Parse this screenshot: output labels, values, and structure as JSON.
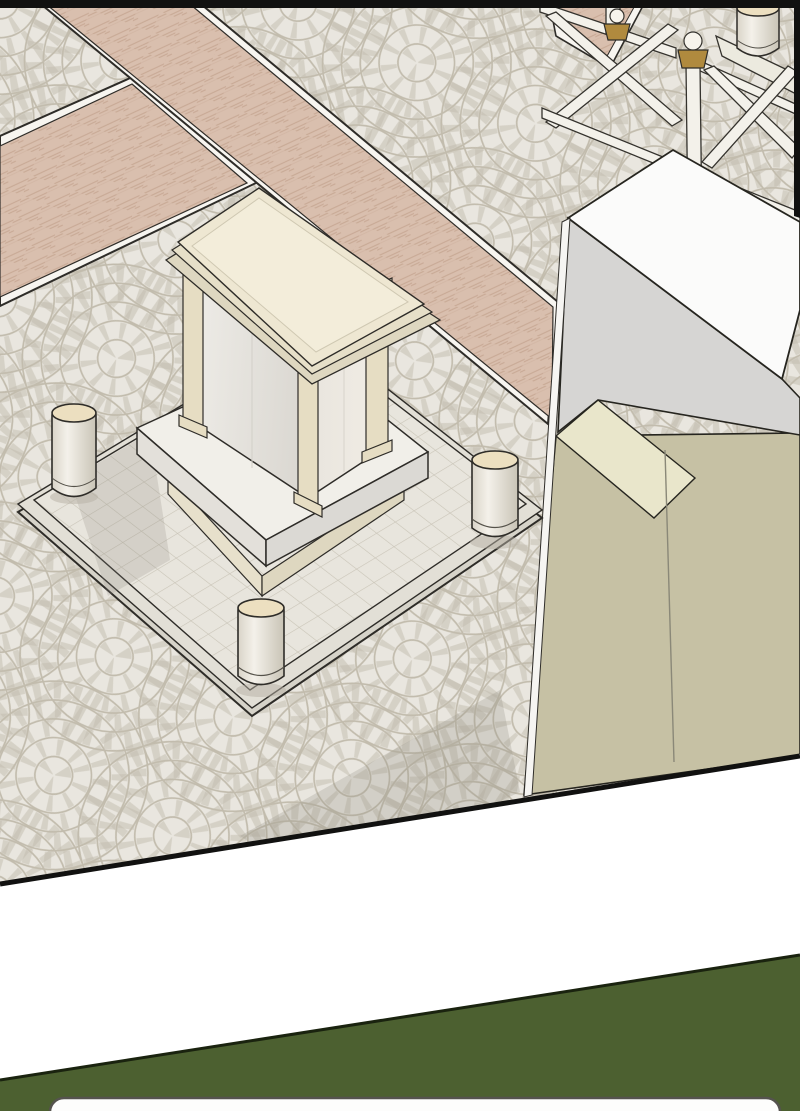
{
  "scene": {
    "kind": "webtoon-comic-panel",
    "description": "SketchUp-style 3D render of a plaza: a white marble monument pedestal with corner pilasters on a tiled platform with four corner bollards, fan-pattern cobblestone paving, pink herringbone brick paths crossing, a white cross-braced railing with brass-capped posts at top right, and a large white/khaki building corner on the right. Below the panel is a white gap, a dark olive-green wedge, and the rounded top of the next panel.",
    "objects": [
      "monument-pedestal",
      "monument-cap",
      "corner-pilasters",
      "stepped-platform",
      "bollard-west",
      "bollard-south",
      "bollard-east",
      "bollard-northeast",
      "cobblestone-plaza",
      "brick-path-northwest",
      "brick-path-southwest",
      "brick-path-top-right",
      "cross-brace-railing",
      "railing-post",
      "brass-post-cap",
      "post-finial-sphere",
      "building-white-block",
      "building-khaki-base",
      "panel-borders",
      "green-gap-band",
      "next-panel-top"
    ]
  },
  "palette": {
    "page_white": "#ffffff",
    "panel_border_black": "#111110",
    "outline": "#2e2c28",
    "cobble_bg": "#e9e6df",
    "cobble_joint": "#c2bcad",
    "path_pink": "#d9bfae",
    "path_pink_line": "#c8a995",
    "curb_white": "#f7f5f0",
    "platform_tile": "#e8e5dd",
    "platform_side": "#dcd9d0",
    "marble_white": "#f1efe9",
    "marble_shade": "#dedbd5",
    "cream_stone": "#e6ddc3",
    "cap_cream": "#eee7d2",
    "cap_cream_light": "#f3edda",
    "plinth_cream": "#e7e0cb",
    "bollard_top_cream": "#ecdfc0",
    "railing_white": "#f3f1ea",
    "brass_gold": "#b08a3e",
    "building_top_white": "#fbfbfa",
    "building_gray": "#d6d5d3",
    "building_khaki": "#c6c1a4",
    "building_cream_top": "#e9e6cb",
    "shadow_gray": "#8f8a7e",
    "gap_green": "#4c6030",
    "gap_green_line": "#1a230f",
    "next_panel_white": "#fdfdfc",
    "next_panel_border": "#55534e"
  }
}
